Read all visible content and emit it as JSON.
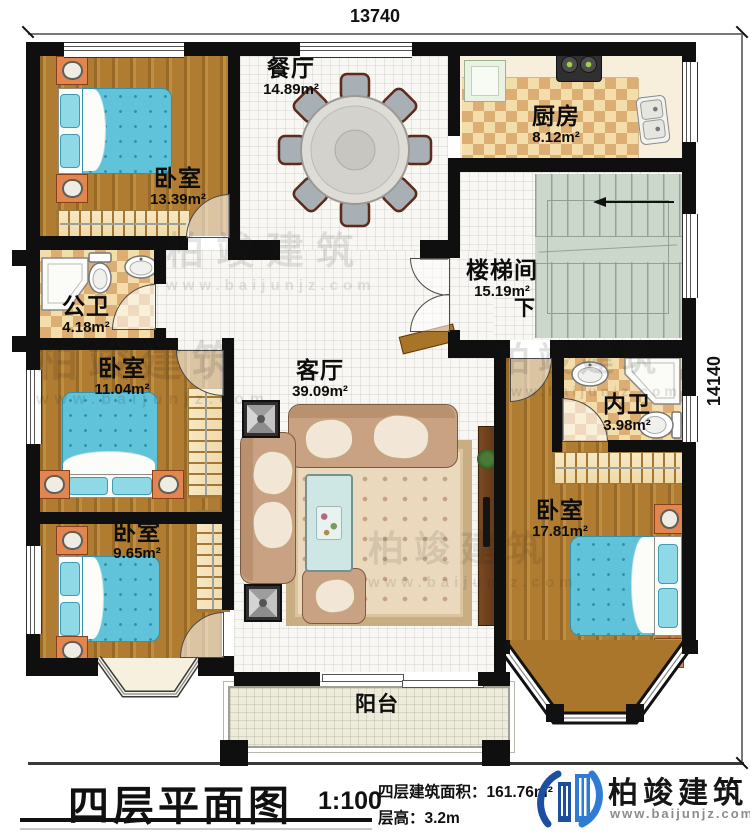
{
  "dimensions": {
    "top": "13740",
    "right": "14140"
  },
  "rooms": {
    "bedroom_top_left": {
      "name": "卧室",
      "area": "13.39m²"
    },
    "dining": {
      "name": "餐厅",
      "area": "14.89m²"
    },
    "kitchen": {
      "name": "厨房",
      "area": "8.12m²"
    },
    "public_bath": {
      "name": "公卫",
      "area": "4.18m²"
    },
    "stairwell": {
      "name": "楼梯间",
      "area": "15.19m²",
      "down_label": "下"
    },
    "bedroom_mid_left": {
      "name": "卧室",
      "area": "11.04m²"
    },
    "living": {
      "name": "客厅",
      "area": "39.09m²"
    },
    "ensuite_bath": {
      "name": "内卫",
      "area": "3.98m²"
    },
    "bedroom_bottom_left": {
      "name": "卧室",
      "area": "9.65m²"
    },
    "bedroom_bottom_right": {
      "name": "卧室",
      "area": "17.81m²"
    },
    "balcony": {
      "name": "阳台"
    }
  },
  "title_block": {
    "title": "四层平面图",
    "scale": "1:100",
    "building_area": "四层建筑面积：161.76m²",
    "floor_height": "层高：3.2m",
    "brand": "柏竣建筑",
    "website": "www.baijunjz.com"
  },
  "watermark": {
    "brand": "柏竣建筑",
    "website": "www.baijunjz.com"
  },
  "colors": {
    "wall": "#0f0f0f",
    "bed": "#61c3da",
    "wood": "#b07c31",
    "brand_blue": "#1d4fa1",
    "brand_light_blue": "#2f7bd6"
  }
}
